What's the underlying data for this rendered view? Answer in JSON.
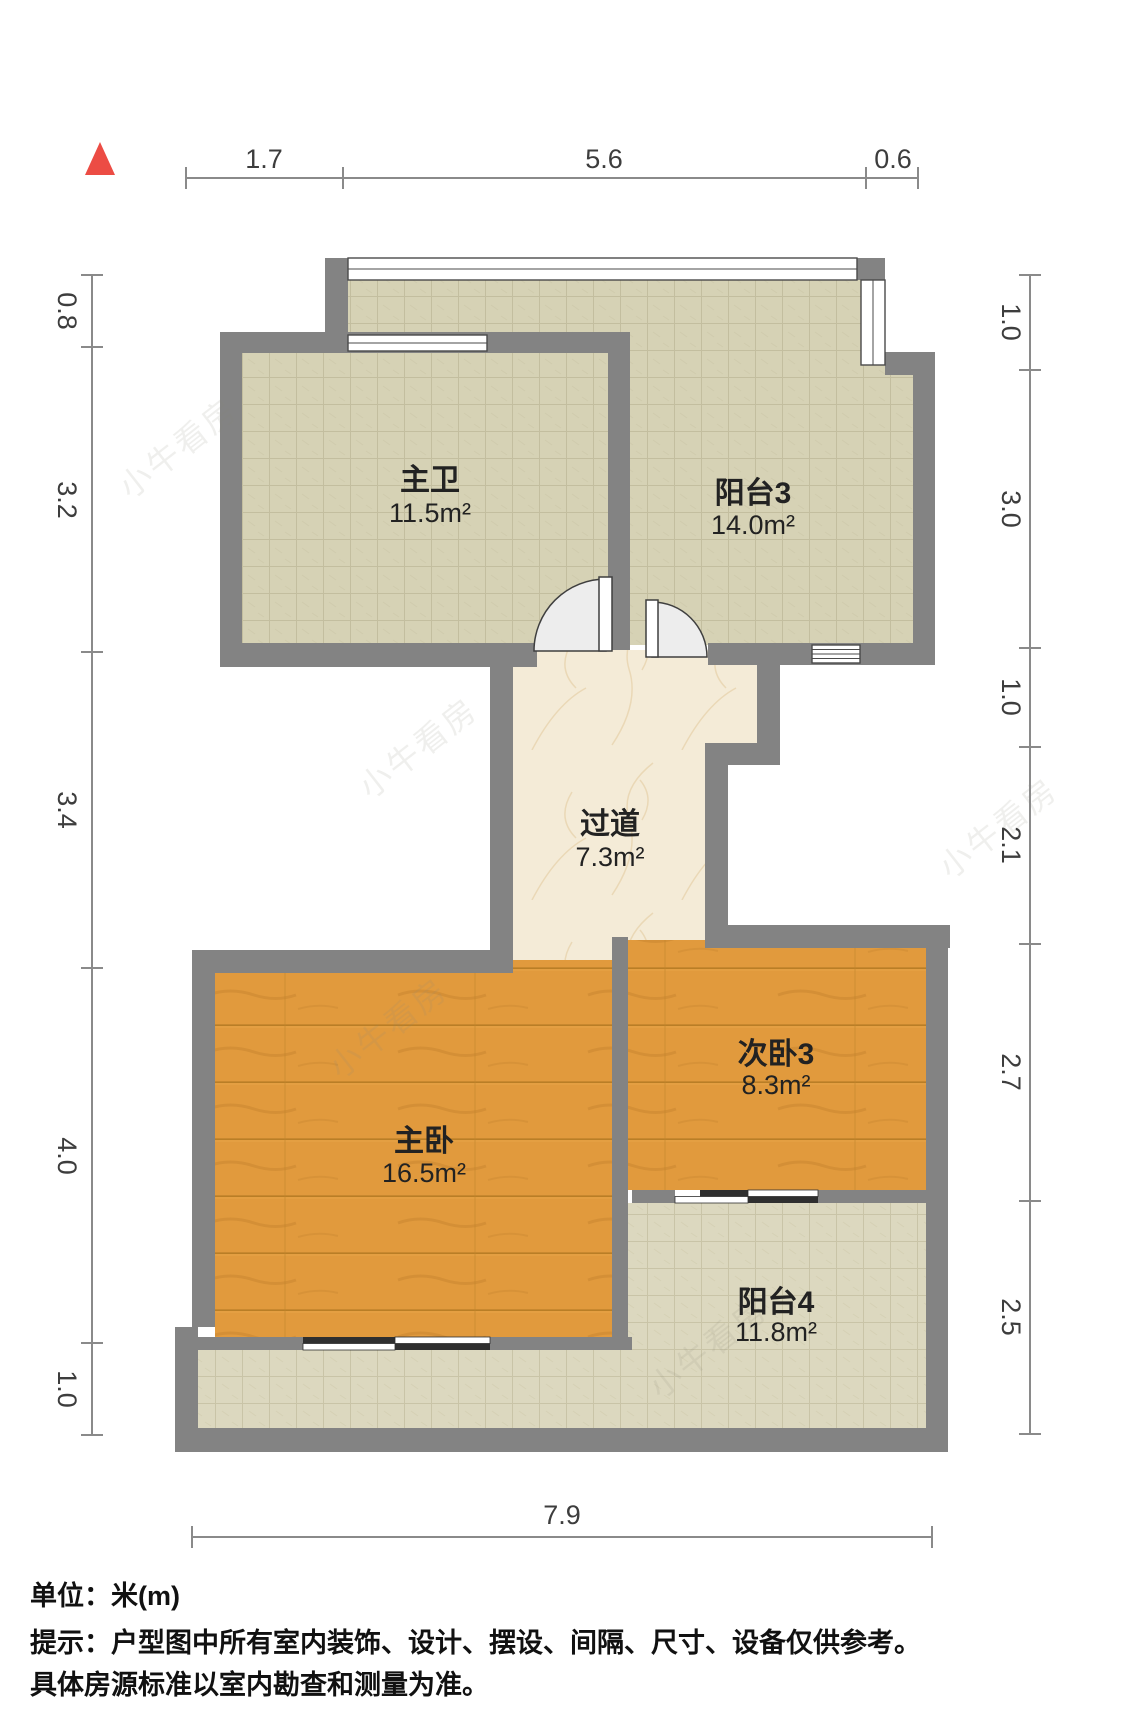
{
  "title": "户型图",
  "compass": {
    "icon": "north-triangle",
    "color": "#ec4c44"
  },
  "rooms": [
    {
      "id": "master-bath",
      "name": "主卫",
      "area": "11.5m²"
    },
    {
      "id": "balcony-3",
      "name": "阳台3",
      "area": "14.0m²"
    },
    {
      "id": "corridor",
      "name": "过道",
      "area": "7.3m²"
    },
    {
      "id": "master-bedroom",
      "name": "主卧",
      "area": "16.5m²"
    },
    {
      "id": "bedroom-3",
      "name": "次卧3",
      "area": "8.3m²"
    },
    {
      "id": "balcony-4",
      "name": "阳台4",
      "area": "11.8m²"
    }
  ],
  "dimensions": {
    "top": [
      "1.7",
      "5.6",
      "0.6"
    ],
    "left": [
      "0.8",
      "3.2",
      "3.4",
      "4.0",
      "1.0"
    ],
    "right": [
      "1.0",
      "3.0",
      "1.0",
      "2.1",
      "2.7",
      "2.5"
    ],
    "bottom": [
      "7.9"
    ]
  },
  "footer": {
    "line1": "单位：米(m)",
    "line2": "提示：户型图中所有室内装饰、设计、摆设、间隔、尺寸、设备仅供参考。",
    "line3": "具体房源标准以室内勘查和测量为准。"
  },
  "watermark": {
    "text": "小牛看房"
  },
  "colors": {
    "wall": "#838383",
    "wood_floor": "#e19a3d",
    "tile_floor": "#d6d2b5",
    "tile_floor_light": "#dcd8bf",
    "marble_floor": "#f4ebd7",
    "compass_red": "#ec4c44",
    "dimension_line": "#8a8a8a",
    "label_text": "#222222"
  }
}
